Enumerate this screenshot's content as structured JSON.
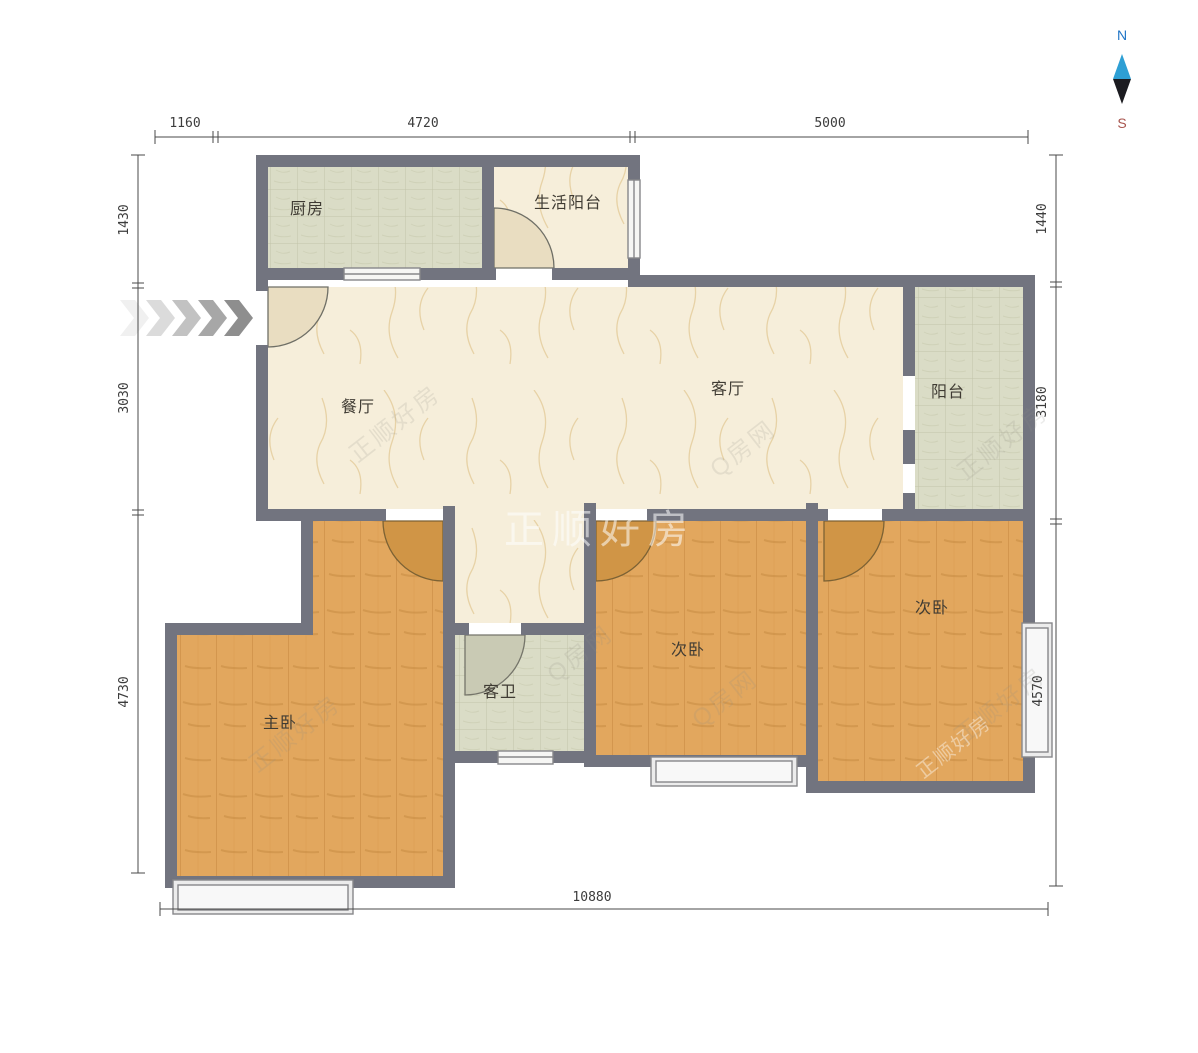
{
  "compass": {
    "north_label": "N",
    "south_label": "S"
  },
  "rooms": {
    "kitchen": {
      "label": "厨房"
    },
    "service_balcony": {
      "label": "生活阳台"
    },
    "dining": {
      "label": "餐厅"
    },
    "living": {
      "label": "客厅"
    },
    "balcony": {
      "label": "阳台"
    },
    "master_bedroom": {
      "label": "主卧"
    },
    "guest_bathroom": {
      "label": "客卫"
    },
    "bedroom_middle": {
      "label": "次卧"
    },
    "bedroom_right": {
      "label": "次卧"
    }
  },
  "dimensions": {
    "top": {
      "d1": "1160",
      "d2": "4720",
      "d3": "5000"
    },
    "left": {
      "d1": "1430",
      "d2": "3030",
      "d3": "4730"
    },
    "right": {
      "d1": "1440",
      "d2": "3180",
      "d3": "4570"
    },
    "bottom": {
      "total": "10880"
    }
  },
  "watermarks": {
    "brand": "正顺好房",
    "site": "Q房网"
  },
  "colors": {
    "wall": "#72747f",
    "wood_floor": "#e2a75e",
    "tile_floor": "#dadcc6",
    "marble_floor": "#f6eeda",
    "door_wood": "#d09546",
    "compass_north": "#2176c7",
    "compass_south": "#a8554e"
  }
}
